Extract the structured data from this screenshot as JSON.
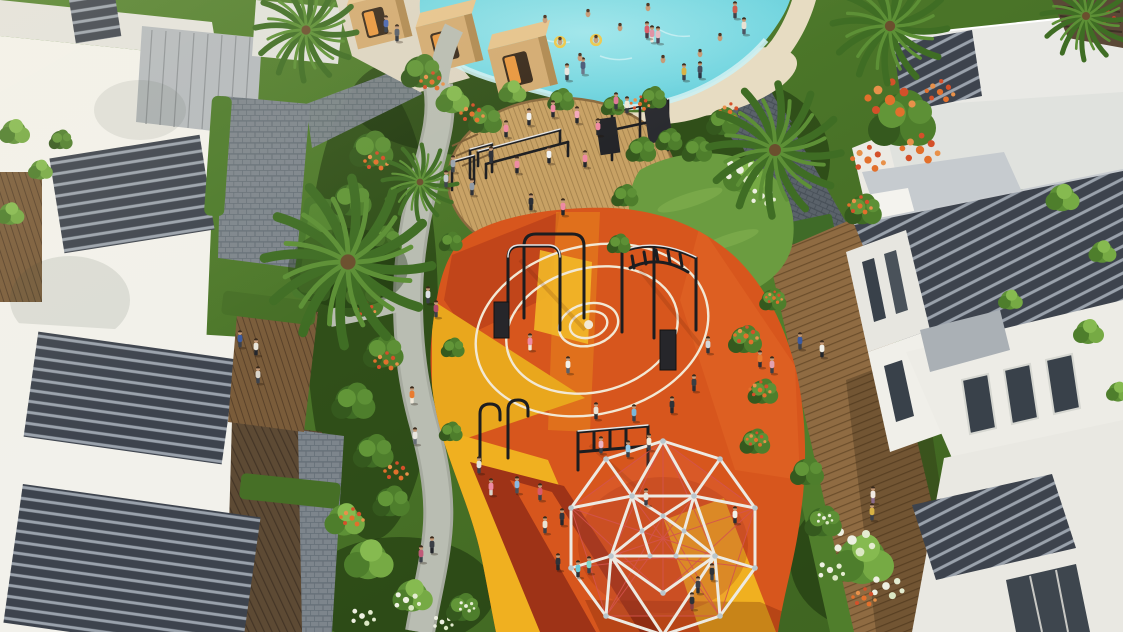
{
  "scene": {
    "label": "aerial-render-community-playground",
    "palette": {
      "pool_water": "#6ed3de",
      "pool_water_light": "#aeeaf0",
      "pool_rim": "#cdeff2",
      "sand": "#e7dcc2",
      "pool_deck": "#ddd5c2",
      "cabana_wood": "#d3ab72",
      "cabana_wood_light": "#e6c48d",
      "cabana_wood_dark": "#b08a52",
      "cabana_window": "#3a2b1c",
      "cabana_glow": "#e8973f",
      "path_concrete": "#b9bdb2",
      "path_concrete_dark": "#a6aa9f",
      "paver": "#7d858c",
      "paver_joint": "#667078",
      "paver_dark": "#5a626a",
      "paver_dark_joint": "#474f57",
      "wood_deck_right": "#8f6b42",
      "wood_deck_right_line": "#6c4e2c",
      "wood_deck_dark": "#5d4a34",
      "wood_deck_dark_line": "#443526",
      "wood_deck_mid": "#7a5c3a",
      "wood_deck_mid_line": "#5a422a",
      "gym_deck_wood": "#c7a164",
      "gym_deck_line": "#a5824c",
      "grass_lawn": "#6b9c40",
      "grass_light": "#7fae4e",
      "green_base": "#4e7a2e",
      "green_base_dark": "#3c611f",
      "foliage_dark": "#3e6a24",
      "foliage_mid": "#4e7e2c",
      "foliage_light": "#76aa44",
      "hedge": "#47762a",
      "flower_orange": "#e2702c",
      "flower_red": "#d4502a",
      "flower_white": "#eef0e2",
      "building_white": "#f2f1eb",
      "building_white_dim": "#e3e2dc",
      "building_gray": "#b4b9bd",
      "louver_dark": "#3d434d",
      "louver_light": "#9aa2ac",
      "roof_slab": "#e9e9e5",
      "terrace_gray": "#c6cbcf",
      "window_dark": "#39414a",
      "play_orange": "#d7561d",
      "play_orange_deep": "#c1451a",
      "play_red_dark": "#9e3317",
      "play_amber": "#e9a71d",
      "play_yellow": "#f0b020",
      "play_orange_light": "#dd5f22",
      "court_line": "#f2e8d4",
      "equipment_black": "#1c1d20",
      "equipment_glint": "#e6e6e6",
      "dome_frame": "#edeae2",
      "dome_joint": "#b9c6cc",
      "dome_net": "#d4544e",
      "skin": "#c59a77"
    },
    "people": [
      {
        "x": 386,
        "y": 26,
        "s": "#4a66b0",
        "p": "#303845"
      },
      {
        "x": 397,
        "y": 35,
        "s": "#565e68",
        "p": "#2c323c"
      },
      {
        "x": 567,
        "y": 74,
        "s": "#e8e6e0",
        "p": "#3a3f48"
      },
      {
        "x": 583,
        "y": 68,
        "s": "#4a5a78",
        "p": "#6a7488"
      },
      {
        "x": 652,
        "y": 36,
        "s": "#e090a4",
        "p": "#ede5d8"
      },
      {
        "x": 684,
        "y": 74,
        "s": "#d8b244",
        "p": "#3a4048"
      },
      {
        "x": 700,
        "y": 72,
        "s": "#434c5c",
        "p": "#2b3240"
      },
      {
        "x": 735,
        "y": 12,
        "s": "#cc5a4a",
        "p": "#3a4048"
      },
      {
        "x": 744,
        "y": 28,
        "s": "#e8e2d4",
        "p": "#4a5260"
      },
      {
        "x": 647,
        "y": 32,
        "s": "#d85a68",
        "p": "#403844"
      },
      {
        "x": 658,
        "y": 37,
        "s": "#e8b8c0",
        "p": "#504456"
      },
      {
        "x": 616,
        "y": 103,
        "s": "#e07898",
        "p": "#35383f"
      },
      {
        "x": 627,
        "y": 107,
        "s": "#efe9d6",
        "p": "#35383f"
      },
      {
        "x": 506,
        "y": 131,
        "s": "#ee8aa2",
        "p": "#23262c"
      },
      {
        "x": 529,
        "y": 119,
        "s": "#f2f2f0",
        "p": "#23262c"
      },
      {
        "x": 553,
        "y": 111,
        "s": "#ee8aa2",
        "p": "#23262c"
      },
      {
        "x": 577,
        "y": 117,
        "s": "#f4a8bc",
        "p": "#23262c"
      },
      {
        "x": 598,
        "y": 129,
        "s": "#ee8aa2",
        "p": "#23262c"
      },
      {
        "x": 491,
        "y": 157,
        "s": "#2c2f36",
        "p": "#2c2f36"
      },
      {
        "x": 517,
        "y": 167,
        "s": "#ee8aa2",
        "p": "#23262c"
      },
      {
        "x": 549,
        "y": 157,
        "s": "#f2f2f0",
        "p": "#23262c"
      },
      {
        "x": 585,
        "y": 161,
        "s": "#ee8aa2",
        "p": "#23262c"
      },
      {
        "x": 531,
        "y": 204,
        "s": "#2c2f36",
        "p": "#23262c"
      },
      {
        "x": 563,
        "y": 209,
        "s": "#ee8aa2",
        "p": "#23262c"
      },
      {
        "x": 472,
        "y": 189,
        "s": "#8e98a4",
        "p": "#2c2f36"
      },
      {
        "x": 453,
        "y": 166,
        "s": "#9aa4ae",
        "p": "#3c424a"
      },
      {
        "x": 446,
        "y": 181,
        "s": "#c2c8ce",
        "p": "#3c424a"
      },
      {
        "x": 428,
        "y": 297,
        "s": "#dde1e4",
        "p": "#3b4048"
      },
      {
        "x": 436,
        "y": 311,
        "s": "#b04a6a",
        "p": "#3b4048"
      },
      {
        "x": 412,
        "y": 397,
        "s": "#e87b30",
        "p": "#efe9db"
      },
      {
        "x": 432,
        "y": 547,
        "s": "#3a3e46",
        "p": "#23262c"
      },
      {
        "x": 421,
        "y": 556,
        "s": "#c05a78",
        "p": "#3b4048"
      },
      {
        "x": 415,
        "y": 438,
        "s": "#e8e6de",
        "p": "#6a7078"
      },
      {
        "x": 240,
        "y": 341,
        "s": "#3b5aa0",
        "p": "#3c4048"
      },
      {
        "x": 256,
        "y": 349,
        "s": "#e9e5da",
        "p": "#23262c"
      },
      {
        "x": 258,
        "y": 377,
        "s": "#d9d5cb",
        "p": "#3c424c"
      },
      {
        "x": 530,
        "y": 344,
        "s": "#ee8aa2",
        "p": "#efe9db"
      },
      {
        "x": 568,
        "y": 367,
        "s": "#f1f0e9",
        "p": "#5a6068"
      },
      {
        "x": 596,
        "y": 413,
        "s": "#e9e3d5",
        "p": "#2a2d33"
      },
      {
        "x": 634,
        "y": 415,
        "s": "#7ab6da",
        "p": "#3b4048"
      },
      {
        "x": 672,
        "y": 407,
        "s": "#2e3238",
        "p": "#23262c"
      },
      {
        "x": 694,
        "y": 385,
        "s": "#3a3e44",
        "p": "#2a2e34"
      },
      {
        "x": 708,
        "y": 347,
        "s": "#d2d6da",
        "p": "#30343a"
      },
      {
        "x": 760,
        "y": 361,
        "s": "#e87b30",
        "p": "#2a2e34"
      },
      {
        "x": 772,
        "y": 367,
        "s": "#e2a2b2",
        "p": "#3b4048"
      },
      {
        "x": 491,
        "y": 489,
        "s": "#ee8aa2",
        "p": "#d9d5cb"
      },
      {
        "x": 517,
        "y": 487,
        "s": "#8ab8e0",
        "p": "#4a5058"
      },
      {
        "x": 479,
        "y": 467,
        "s": "#e2e2dc",
        "p": "#3b4048"
      },
      {
        "x": 601,
        "y": 447,
        "s": "#eab2c2",
        "p": "#3b4048"
      },
      {
        "x": 628,
        "y": 451,
        "s": "#92cae8",
        "p": "#3b4048"
      },
      {
        "x": 649,
        "y": 444,
        "s": "#f1ead9",
        "p": "#3b4048"
      },
      {
        "x": 545,
        "y": 527,
        "s": "#e9e3d3",
        "p": "#3b4048"
      },
      {
        "x": 558,
        "y": 564,
        "s": "#2e3238",
        "p": "#23262c"
      },
      {
        "x": 589,
        "y": 567,
        "s": "#81d6ca",
        "p": "#3b4048"
      },
      {
        "x": 540,
        "y": 494,
        "s": "#d85a6a",
        "p": "#3b4048"
      },
      {
        "x": 562,
        "y": 519,
        "s": "#30343c",
        "p": "#23262c"
      },
      {
        "x": 578,
        "y": 571,
        "s": "#6acad8",
        "p": "#2e3238"
      },
      {
        "x": 735,
        "y": 517,
        "s": "#f1f0e9",
        "p": "#2a2e34"
      },
      {
        "x": 712,
        "y": 574,
        "s": "#2e3238",
        "p": "#3b4048"
      },
      {
        "x": 698,
        "y": 587,
        "s": "#3c4048",
        "p": "#2a2e34"
      },
      {
        "x": 692,
        "y": 603,
        "s": "#2e3238",
        "p": "#8a4040"
      },
      {
        "x": 646,
        "y": 499,
        "s": "#e9e5dd",
        "p": "#3b4048"
      },
      {
        "x": 800,
        "y": 343,
        "s": "#3b5aa0",
        "p": "#3c4048"
      },
      {
        "x": 822,
        "y": 351,
        "s": "#f1f0e9",
        "p": "#23262c"
      },
      {
        "x": 873,
        "y": 497,
        "s": "#f1e9e1",
        "p": "#8a6a8a"
      },
      {
        "x": 872,
        "y": 514,
        "s": "#d8b244",
        "p": "#3b4048"
      }
    ],
    "swimmers": [
      {
        "x": 560,
        "y": 42,
        "r": true
      },
      {
        "x": 596,
        "y": 40,
        "r": true
      },
      {
        "x": 588,
        "y": 14,
        "r": false
      },
      {
        "x": 648,
        "y": 8,
        "r": false
      },
      {
        "x": 620,
        "y": 28,
        "r": false
      },
      {
        "x": 700,
        "y": 54,
        "r": false
      },
      {
        "x": 580,
        "y": 58,
        "r": false
      },
      {
        "x": 545,
        "y": 20,
        "r": false
      },
      {
        "x": 720,
        "y": 38,
        "r": false
      },
      {
        "x": 663,
        "y": 60,
        "r": false
      }
    ]
  }
}
